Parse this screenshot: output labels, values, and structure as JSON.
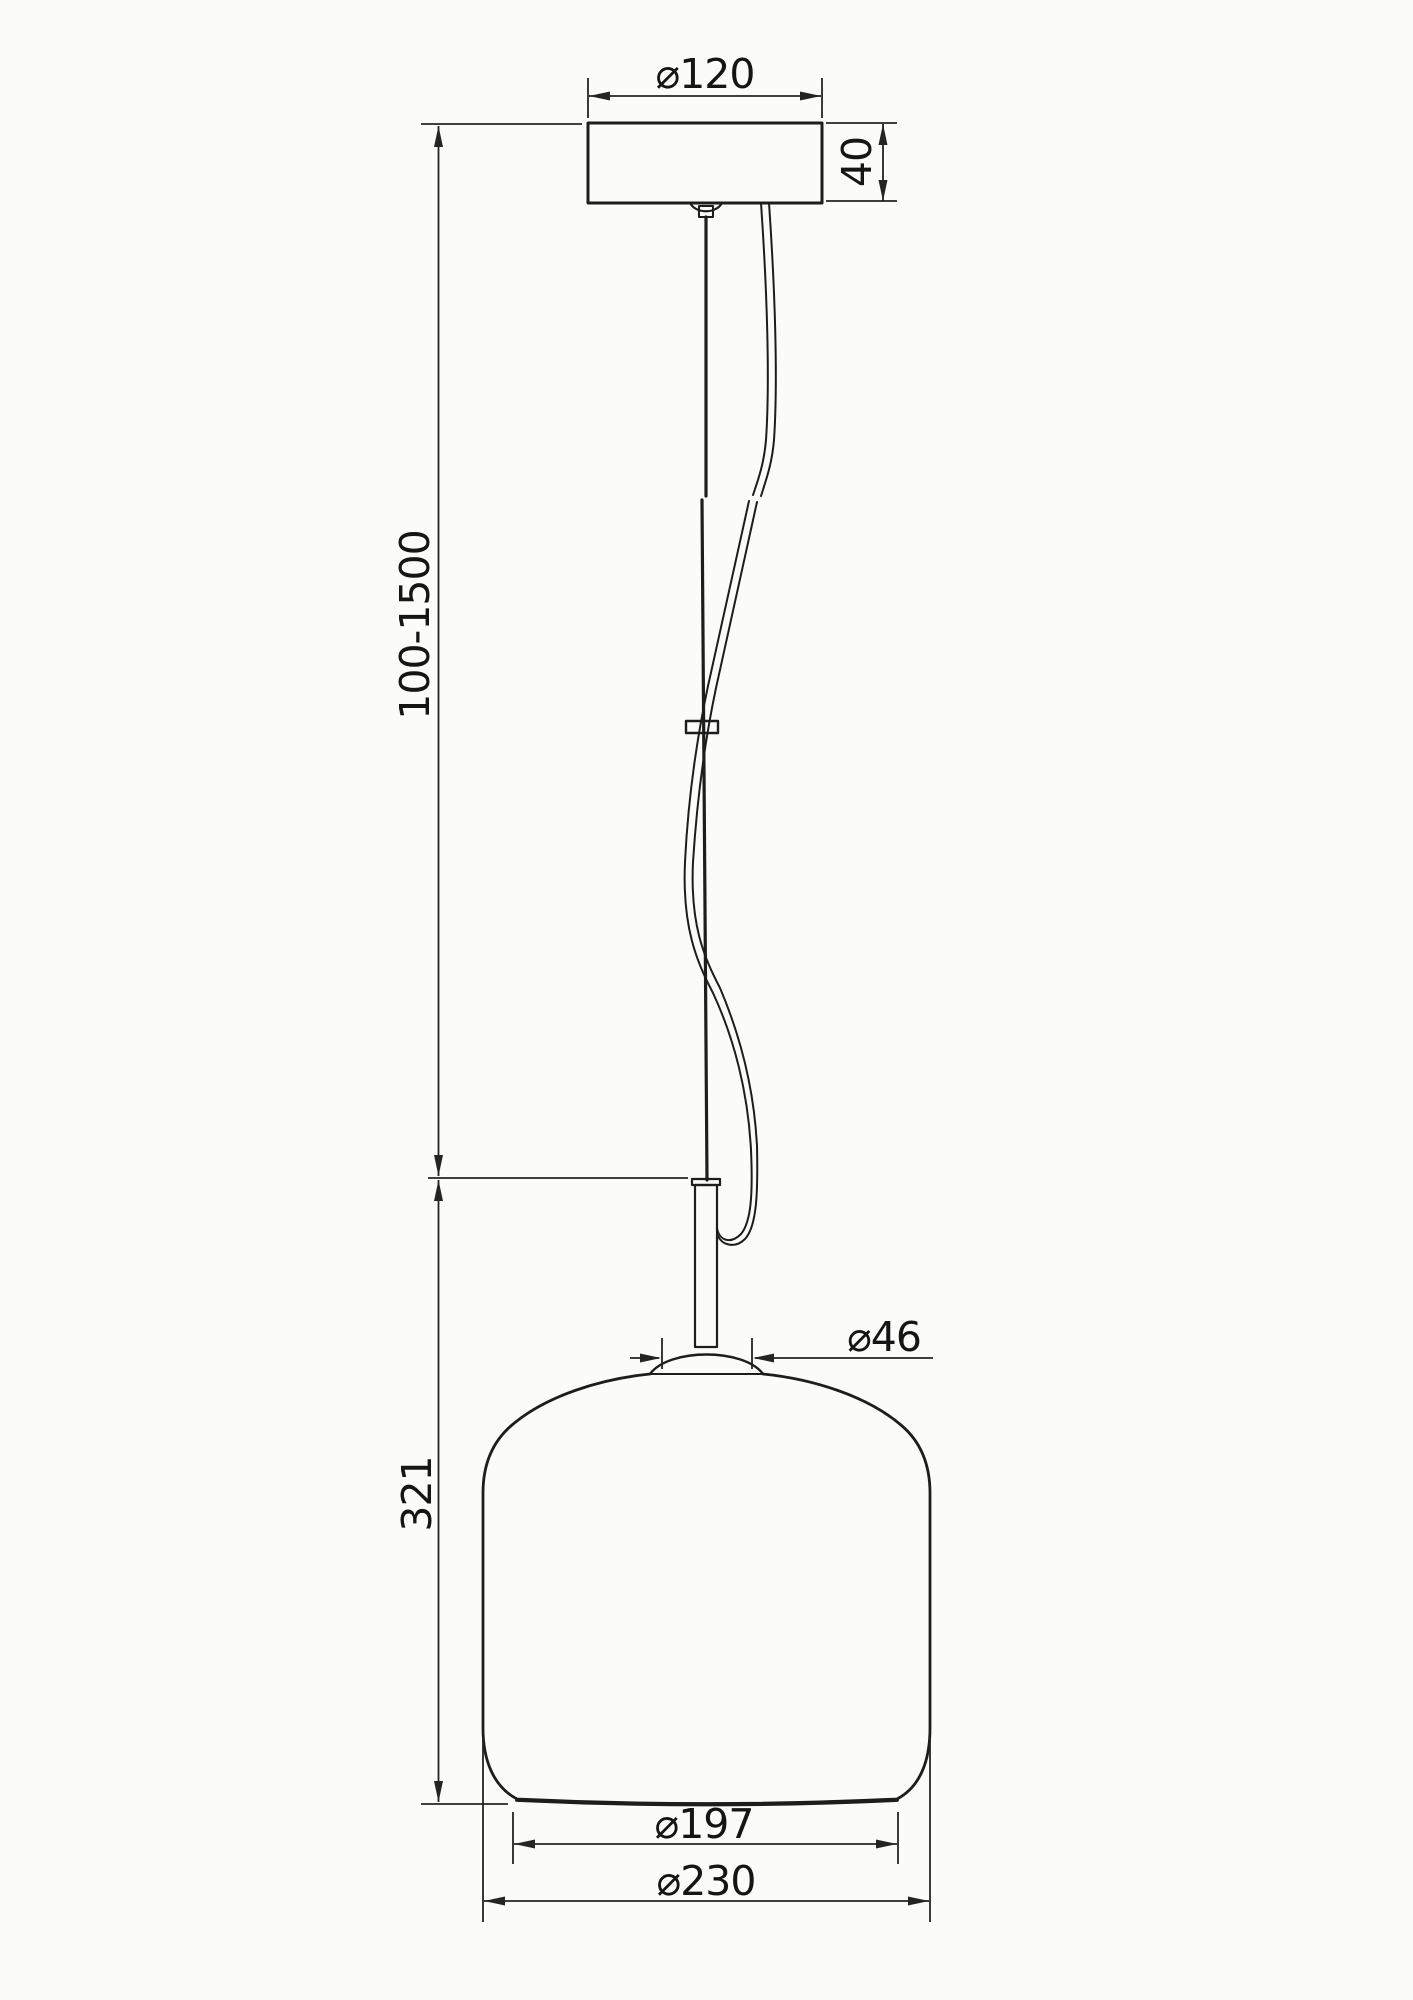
{
  "drawing": {
    "labels": {
      "canopy_diameter": "⌀120",
      "canopy_height": "40",
      "suspension_length": "100-1500",
      "body_height": "321",
      "neck_diameter": "⌀46",
      "bottom_opening_diameter": "⌀197",
      "max_diameter": "⌀230"
    },
    "colors": {
      "background": "#fbfbfa",
      "line": "#1d1d1d",
      "dimension": "#242424",
      "text": "#151515"
    }
  }
}
